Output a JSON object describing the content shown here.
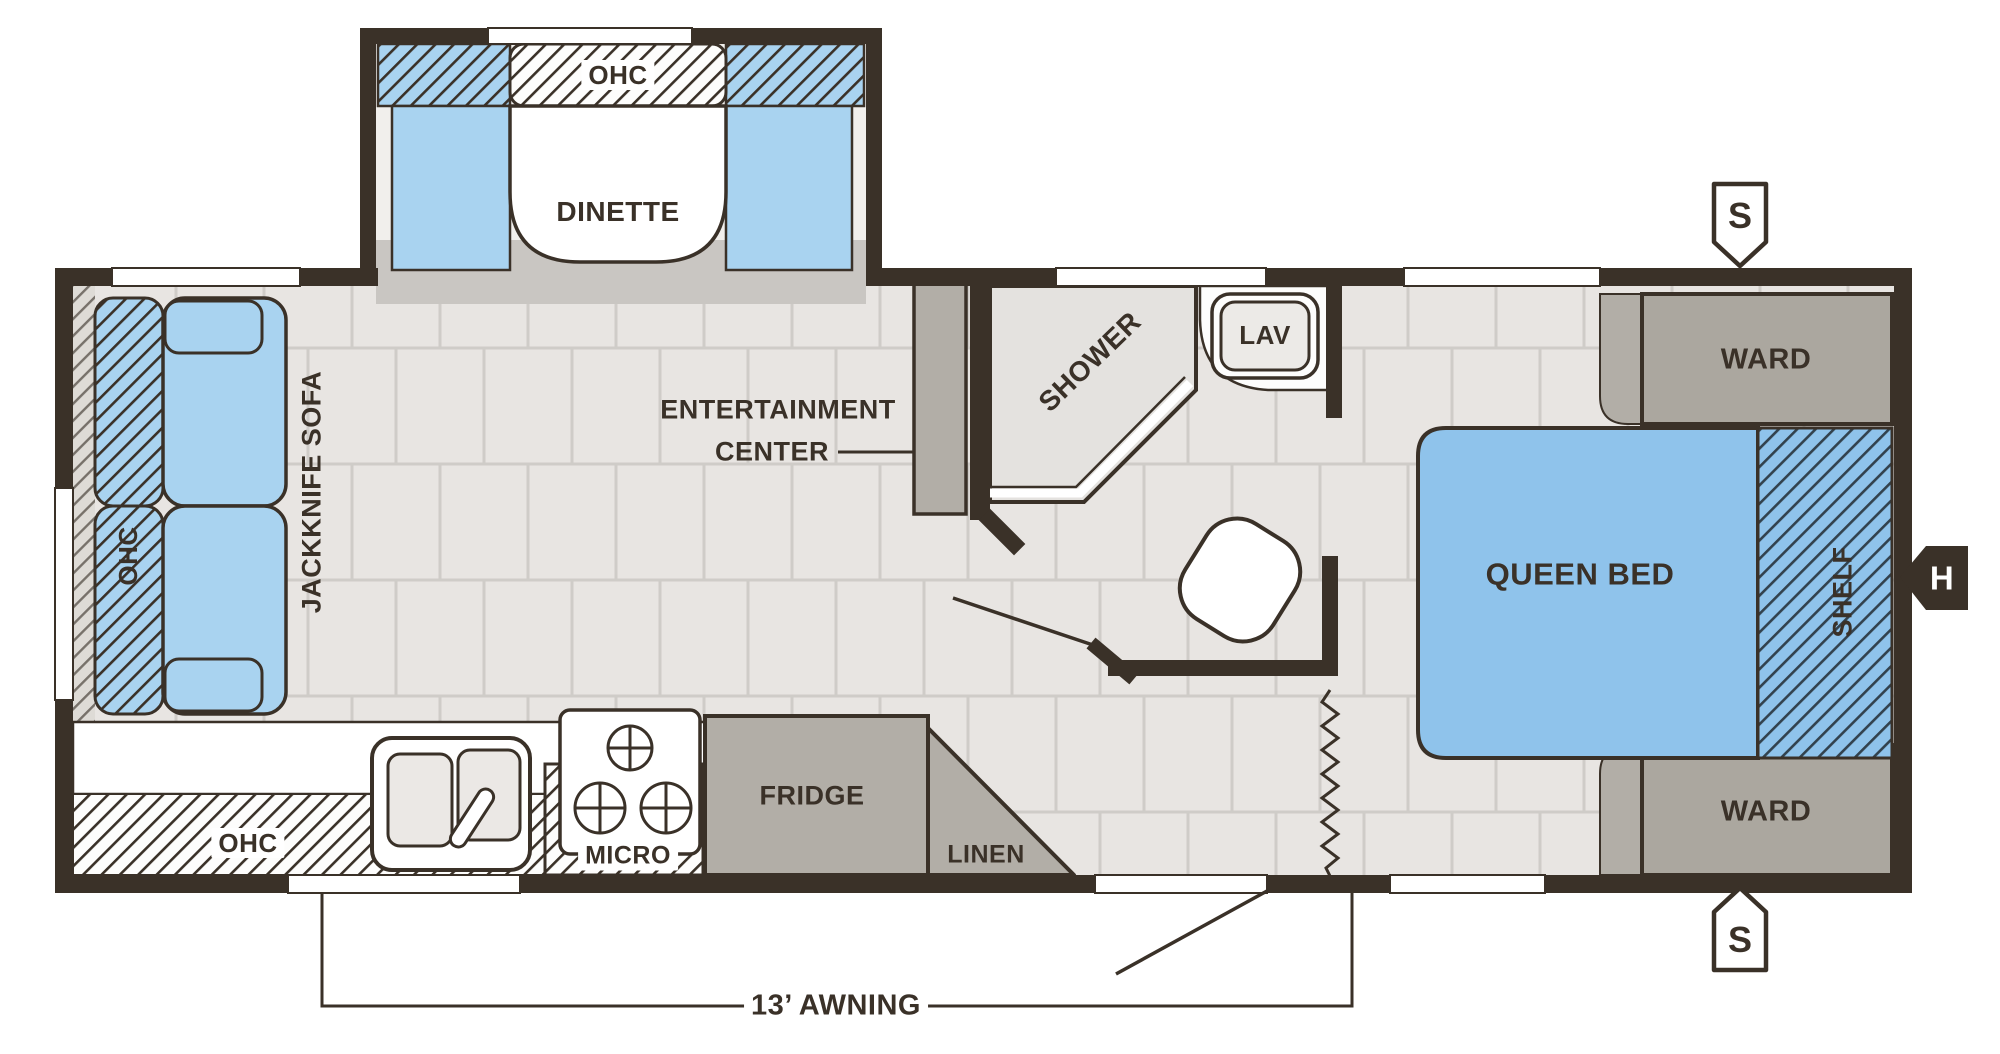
{
  "figure": {
    "type": "rv-travel-trailer-floor-plan",
    "colors": {
      "wall": "#3a3128",
      "furniture_blue": "#a9d3f0",
      "bed_blue": "#8fc3eb",
      "cabinet_gray": "#b2aea7",
      "floor": "#e8e5e2",
      "shower_floor": "#e4e2df"
    }
  },
  "labels": {
    "dinette_ohc": "OHC",
    "dinette": "DINETTE",
    "sofa_ohc": "OHC",
    "jackknife_sofa": "JACKKNIFE SOFA",
    "entertainment_line1": "ENTERTAINMENT",
    "entertainment_line2": "CENTER",
    "shower": "SHOWER",
    "lav": "LAV",
    "ward_top": "WARD",
    "ward_bottom": "WARD",
    "queen_bed": "QUEEN BED",
    "shelf": "SHELF",
    "kitchen_ohc": "OHC",
    "micro": "MICRO",
    "fridge": "FRIDGE",
    "linen": "LINEN",
    "awning": "13’ AWNING",
    "speaker_top": "S",
    "speaker_bottom": "S",
    "hitch": "H"
  }
}
